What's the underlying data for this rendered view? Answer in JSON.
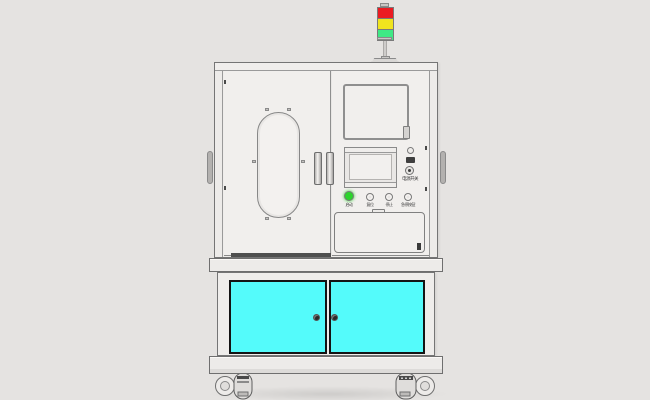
{
  "scene": {
    "background_color": "#E5E3E1",
    "machine_body_color": "#EFEDEB",
    "outline_color": "#757575"
  },
  "tower_light": {
    "segments": [
      {
        "name": "red",
        "color": "#EB1B22"
      },
      {
        "name": "yellow",
        "color": "#F0E41E"
      },
      {
        "name": "green",
        "color": "#3FE985"
      }
    ]
  },
  "control_panel": {
    "buttons": [
      {
        "label": "启动",
        "color": "#2BD42B",
        "lit": true
      },
      {
        "label": "复位",
        "color": "#E8E6E4",
        "lit": false
      },
      {
        "label": "停止",
        "color": "#E8E6E4",
        "lit": false
      },
      {
        "label": "急停按钮",
        "color": "#E8E6E4",
        "lit": false
      }
    ],
    "side_label": "电源开关"
  },
  "lower_cabinet": {
    "door_color": "#54FBFB"
  }
}
